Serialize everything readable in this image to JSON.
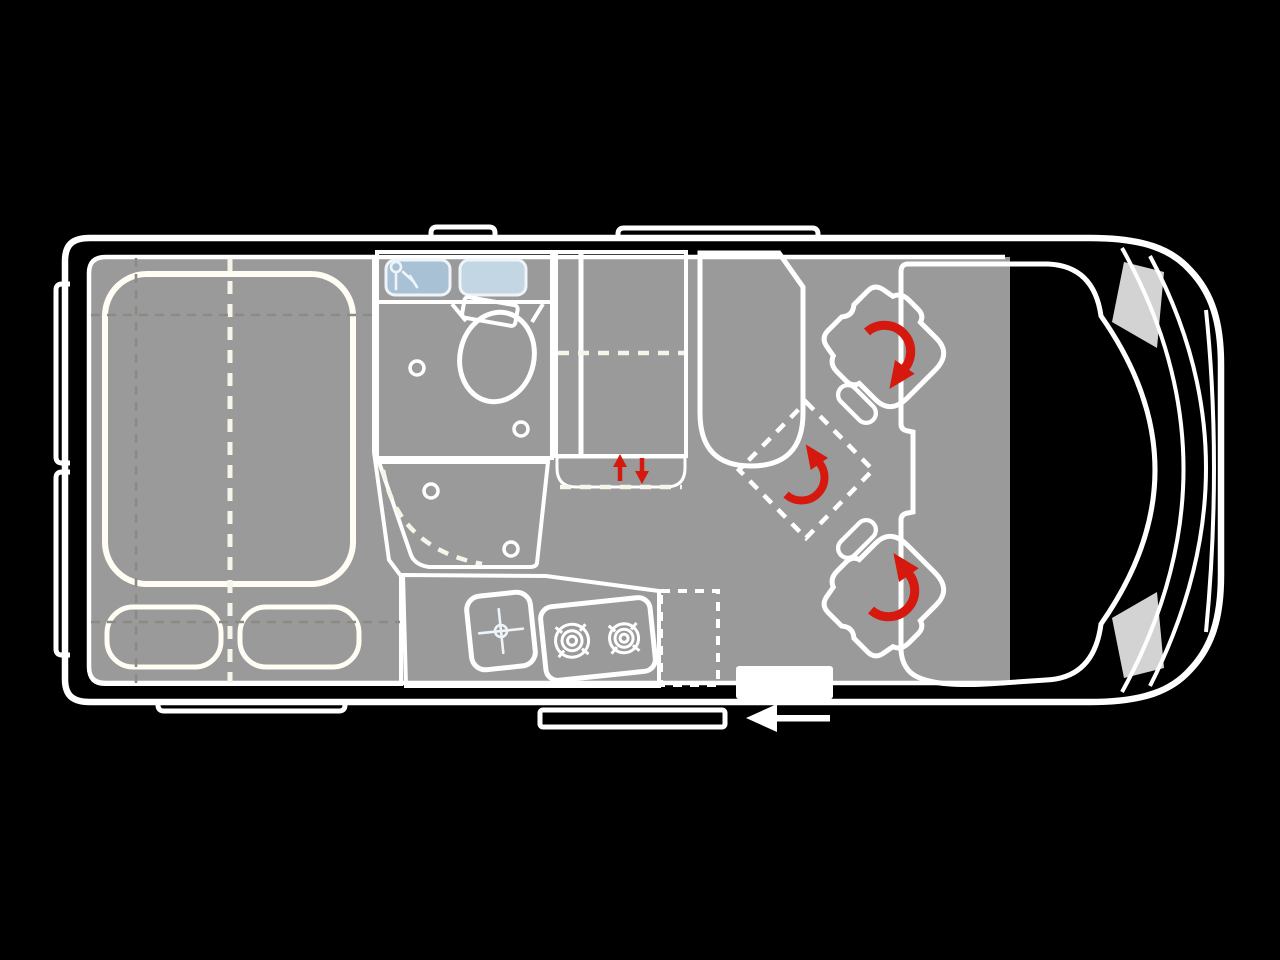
{
  "page": {
    "title": "Campervan top-view floor plan diagram",
    "background": "#000000"
  },
  "colors": {
    "outline": "#ffffff",
    "body_gray": "#a9a9a9",
    "floor_gray": "#9a9a9a",
    "bed_beige": "#d9d0b2",
    "wardrobe_beige": "#d3caa9",
    "wardrobe_base": "#eae4d4",
    "bath_strip": "#c8d7e3",
    "bath_panel_dark": "#a9c1d4",
    "bath_panel_light": "#c3d6e4",
    "bath_blue": "#c1d2e0",
    "toilet_blue": "#b3c9db",
    "cistern_blue": "#bccedd",
    "shower_blue": "#bed0de",
    "kitchen_green": "#cedcc9",
    "appliance_gray": "#a7a9a3",
    "bench_pink": "#d9b9ac",
    "diamond_pink": "#dcc1b5",
    "seat_beige": "#ddd5b4",
    "cab_floor": "#d8d8d8",
    "headlight": "#d3d3d3",
    "arrow_red": "#d6190e",
    "step_white": "#ffffff",
    "dash_gray": "#8b8b84"
  },
  "areas": {
    "bed": "rear-double-bed",
    "bathroom": "washroom-with-toilet-and-shower",
    "wardrobe": "wardrobe-cabinet-with-lift-mechanism",
    "kitchen": "kitchen-block-with-sink-and-two-burner-stove",
    "bench": "side-bench-seat",
    "extra_seat": "fold-out-travel-seat",
    "cab": "driver-cab-with-two-swivel-seats",
    "entry": "sliding-door-entry-with-step"
  },
  "icons": {
    "faucet": "faucet-icon",
    "sink_cross": "sink-tap-cross-icon",
    "burners": "gas-burner-icon",
    "swivel": "rotation-arrow-icon",
    "lift": "up-down-arrows-icon",
    "entry_arrow": "entry-direction-arrow-icon"
  }
}
